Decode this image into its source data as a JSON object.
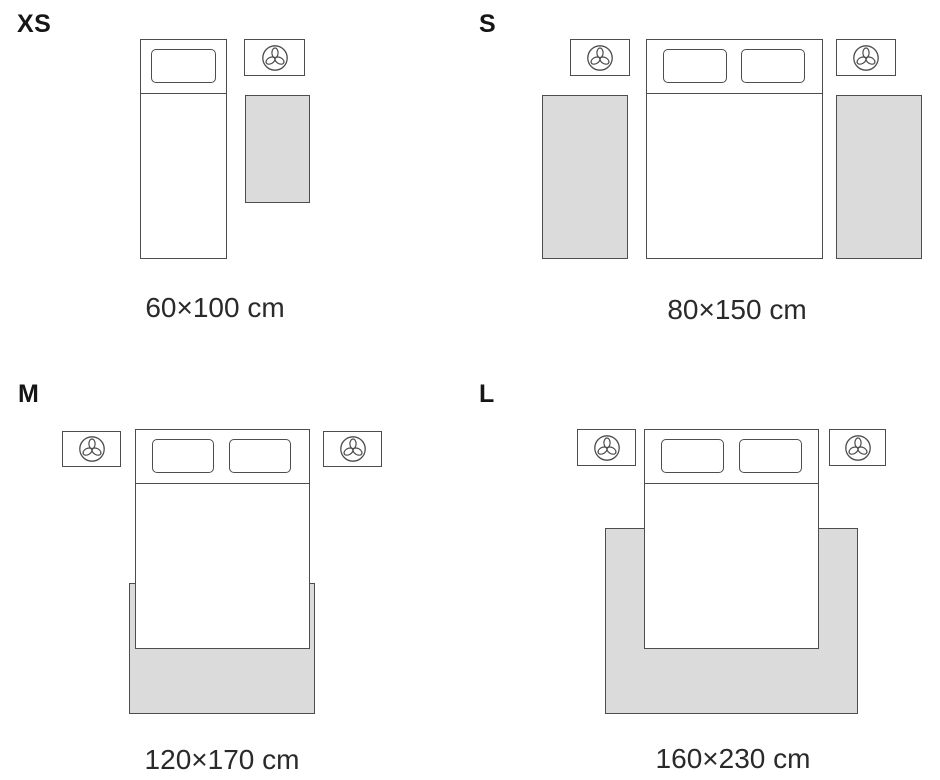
{
  "colors": {
    "line": "#4d4d4d",
    "rug_fill": "#dbdbdb",
    "text": "#2a2a2a"
  },
  "icons": {
    "nightstand_icon": "plant-top-view-icon"
  },
  "sizes": [
    {
      "id": "xs",
      "label": "XS",
      "dimensions": "60×100 cm",
      "layout": "single bed, one nightstand, rug beside bed"
    },
    {
      "id": "s",
      "label": "S",
      "dimensions": "80×150 cm",
      "layout": "double bed, two nightstands, runner rug on each side"
    },
    {
      "id": "m",
      "label": "M",
      "dimensions": "120×170 cm",
      "layout": "double bed, two nightstands, rug under foot of bed"
    },
    {
      "id": "l",
      "label": "L",
      "dimensions": "160×230 cm",
      "layout": "double bed, two nightstands, large rug under bed"
    }
  ]
}
